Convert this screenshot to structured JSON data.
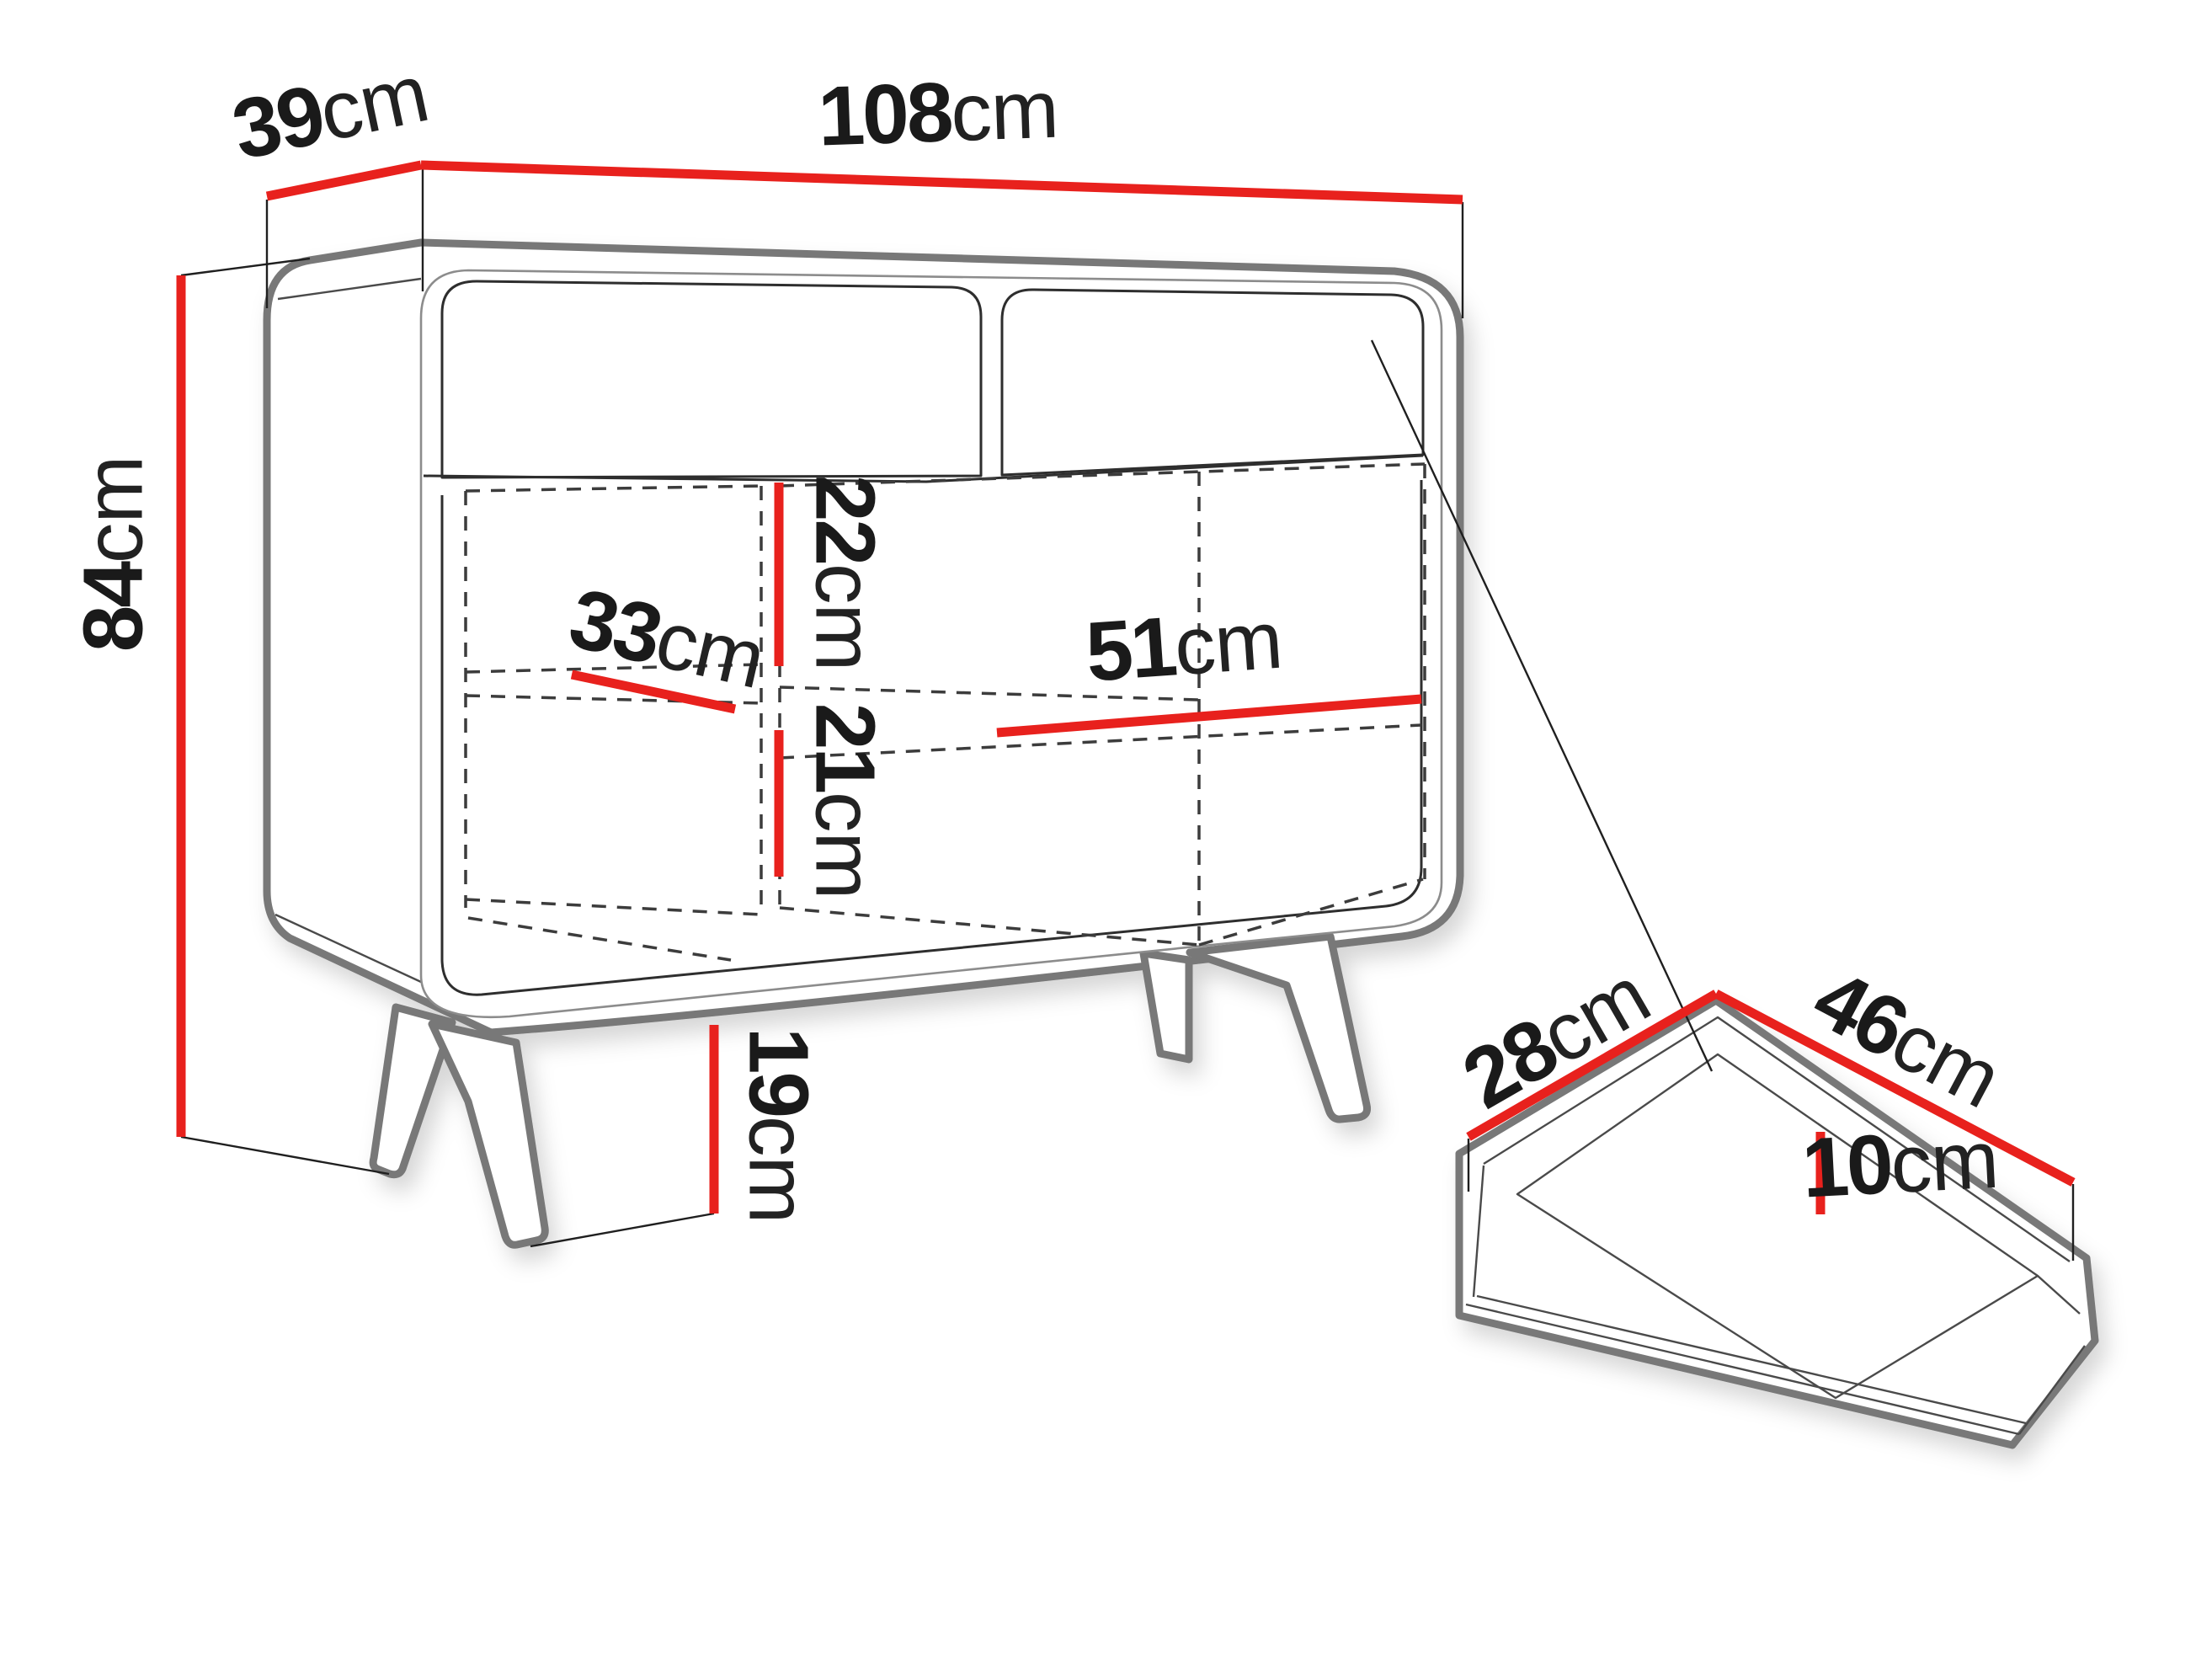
{
  "diagram": {
    "type": "furniture-dimension-diagram",
    "subject": "sideboard cabinet on splayed legs with pull-out drawer detail",
    "unit": "cm",
    "palette": {
      "dimension_red": "#e8211d",
      "outline_gray": "#787878",
      "line_dark": "#2e2e2e",
      "text_dark": "#1a1a1a",
      "background": "#ffffff"
    },
    "cabinet": {
      "dims": {
        "depth": {
          "value": "39",
          "unit": "cm"
        },
        "width": {
          "value": "108",
          "unit": "cm"
        },
        "height": {
          "value": "84",
          "unit": "cm"
        },
        "upper_niche_height": {
          "value": "22",
          "unit": "cm"
        },
        "shelf_depth": {
          "value": "33",
          "unit": "cm"
        },
        "niche_width": {
          "value": "51",
          "unit": "cm"
        },
        "lower_niche_height": {
          "value": "21",
          "unit": "cm"
        },
        "leg_height": {
          "value": "19",
          "unit": "cm"
        }
      }
    },
    "drawer": {
      "dims": {
        "depth": {
          "value": "28",
          "unit": "cm"
        },
        "width": {
          "value": "46",
          "unit": "cm"
        },
        "height": {
          "value": "10",
          "unit": "cm"
        }
      }
    }
  }
}
